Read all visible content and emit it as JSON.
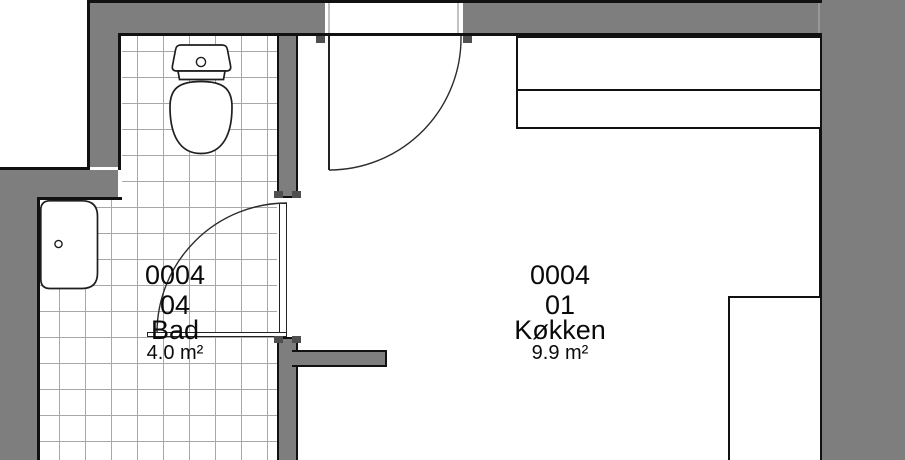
{
  "floorplan": {
    "rooms": [
      {
        "id": "0004",
        "unit": "04",
        "name": "Bad",
        "area": "4.0 m²"
      },
      {
        "id": "0004",
        "unit": "01",
        "name": "Køkken",
        "area": "9.9 m²"
      }
    ],
    "colors": {
      "wall_fill": "#7e7e7e",
      "wall_outline": "#111111",
      "tile_line": "#a8a8a8",
      "door_stop": "#4f4f4f",
      "fixture_line": "#1e1e1e",
      "background": "#ffffff"
    }
  }
}
